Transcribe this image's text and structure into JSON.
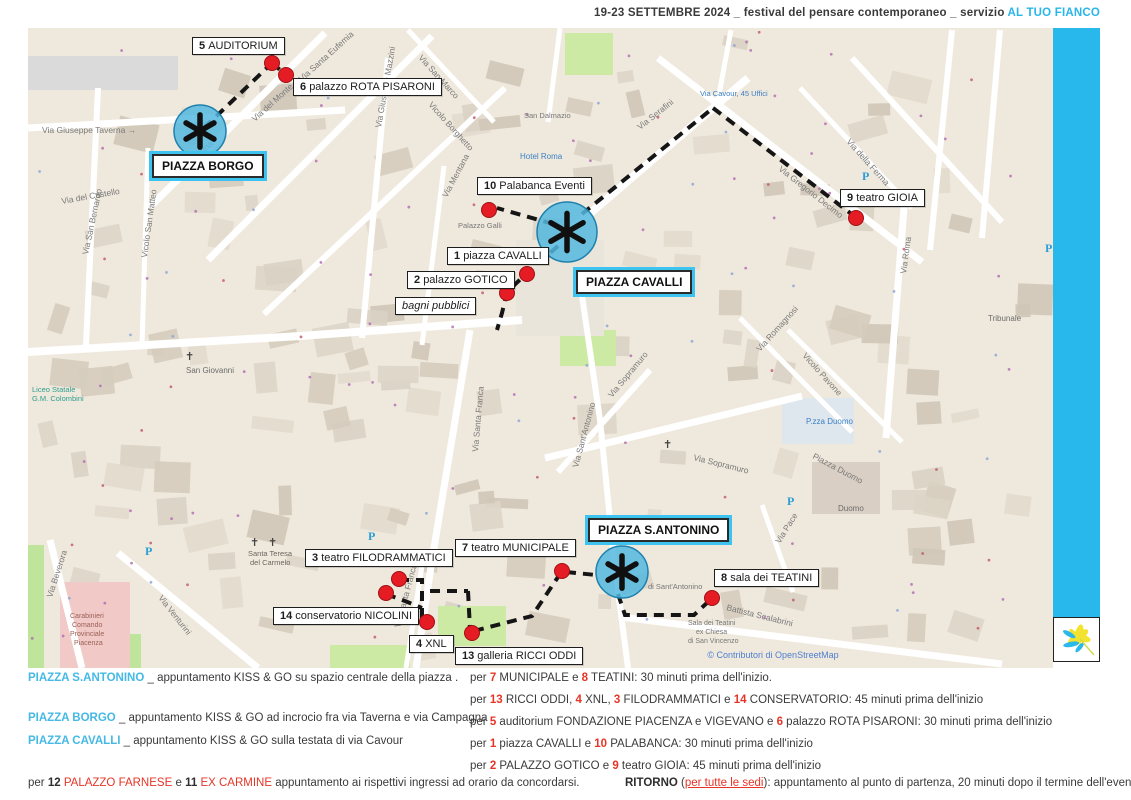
{
  "header": {
    "title_plain": "19-23 SETTEMBRE 2024 _ festival del pensare contemporaneo _ servizio ",
    "title_accent": "AL TUO FIANCO"
  },
  "colors": {
    "accent": "#29b8eb",
    "red_dot": "#e51c23",
    "route": "#151515",
    "kissgo_fill": "#55b8df",
    "kissgo_stroke": "#1f81ad"
  },
  "map": {
    "attribution": "© Contributori di OpenStreetMap",
    "kiss_go_points": [
      {
        "name": "piazza-borgo",
        "x": 200,
        "y": 131,
        "r": 26
      },
      {
        "name": "piazza-cavalli",
        "x": 567,
        "y": 232,
        "r": 30
      },
      {
        "name": "piazza-santantonino",
        "x": 622,
        "y": 572,
        "r": 26
      }
    ],
    "piazza_labels": [
      {
        "text": "PIAZZA BORGO",
        "x": 152,
        "y": 154
      },
      {
        "text": "PIAZZA CAVALLI",
        "x": 576,
        "y": 270
      },
      {
        "text": "PIAZZA S.ANTONINO",
        "x": 588,
        "y": 518
      }
    ],
    "venues": [
      {
        "num": "5",
        "name": "AUDITORIUM",
        "x": 192,
        "y": 37,
        "dot": {
          "x": 272,
          "y": 63
        }
      },
      {
        "num": "6",
        "name": "palazzo ROTA PISARONI",
        "x": 293,
        "y": 78,
        "dot": {
          "x": 286,
          "y": 75
        }
      },
      {
        "num": "10",
        "name": "Palabanca Eventi",
        "x": 477,
        "y": 177,
        "dot": {
          "x": 489,
          "y": 210
        }
      },
      {
        "num": "1",
        "name": "piazza CAVALLI",
        "x": 447,
        "y": 247,
        "dot": {
          "x": 527,
          "y": 274
        }
      },
      {
        "num": "2",
        "name": "palazzo GOTICO",
        "x": 407,
        "y": 271,
        "dot": {
          "x": 507,
          "y": 293
        }
      },
      {
        "num": "",
        "name": "bagni pubblici",
        "italic": true,
        "x": 395,
        "y": 297,
        "dot": null
      },
      {
        "num": "9",
        "name": "teatro GIOIA",
        "x": 840,
        "y": 189,
        "dot": {
          "x": 856,
          "y": 218
        }
      },
      {
        "num": "7",
        "name": "teatro MUNICIPALE",
        "x": 455,
        "y": 539,
        "dot": {
          "x": 562,
          "y": 571
        }
      },
      {
        "num": "3",
        "name": "teatro FILODRAMMATICI",
        "x": 305,
        "y": 549,
        "dot": {
          "x": 399,
          "y": 579
        }
      },
      {
        "num": "14",
        "name": "conservatorio NICOLINI",
        "x": 273,
        "y": 607,
        "dot": {
          "x": 386,
          "y": 593
        }
      },
      {
        "num": "4",
        "name": "XNL",
        "x": 409,
        "y": 635,
        "dot": {
          "x": 427,
          "y": 622
        }
      },
      {
        "num": "13",
        "name": "galleria RICCI ODDI",
        "x": 455,
        "y": 647,
        "dot": {
          "x": 472,
          "y": 633
        }
      },
      {
        "num": "8",
        "name": "sala dei TEATINI",
        "x": 714,
        "y": 569,
        "dot": {
          "x": 712,
          "y": 598
        }
      }
    ],
    "routes": [
      "204,128 272,63",
      "272,63 286,75",
      "582,214 713,108",
      "713,108 854,216",
      "553,224 497,208",
      "558,246 527,273 507,292 502,313 497,330",
      "399,580 422,580 422,621",
      "386,594 405,601 422,608",
      "430,591 468,591",
      "468,591 470,629",
      "474,631 532,616 560,574",
      "566,572 596,575",
      "618,594 625,615 694,615 709,601"
    ],
    "street_labels": [
      {
        "t": "Via Giuseppe Taverna →",
        "x": 42,
        "y": 133,
        "r": 0
      },
      {
        "t": "Via San Bernardo",
        "x": 88,
        "y": 255,
        "r": -78
      },
      {
        "t": "Via del Castello",
        "x": 62,
        "y": 204,
        "r": -10
      },
      {
        "t": "Vicolo San Matteo",
        "x": 147,
        "y": 258,
        "r": -82
      },
      {
        "t": "Via Campagna",
        "x": 172,
        "y": 182,
        "r": -42
      },
      {
        "t": "Via del Monte",
        "x": 255,
        "y": 122,
        "r": -42
      },
      {
        "t": "Via Santa Eufemia",
        "x": 302,
        "y": 82,
        "r": -42
      },
      {
        "t": "Via San Marco",
        "x": 418,
        "y": 58,
        "r": 48
      },
      {
        "t": "Vicolo Borghetto",
        "x": 428,
        "y": 105,
        "r": 48
      },
      {
        "t": "Via Giuseppe Mazzini",
        "x": 381,
        "y": 128,
        "r": -80
      },
      {
        "t": "Via Mentana",
        "x": 447,
        "y": 198,
        "r": -62
      },
      {
        "t": "Via Serafini",
        "x": 640,
        "y": 130,
        "r": -38
      },
      {
        "t": "Via Gregorio Decimo",
        "x": 778,
        "y": 170,
        "r": 38
      },
      {
        "t": "Via della Ferma",
        "x": 846,
        "y": 142,
        "r": 48
      },
      {
        "t": "Via Romagnosi",
        "x": 760,
        "y": 352,
        "r": -48
      },
      {
        "t": "Vicolo Pavone",
        "x": 802,
        "y": 356,
        "r": 48
      },
      {
        "t": "Via Sopramuro",
        "x": 612,
        "y": 398,
        "r": -50
      },
      {
        "t": "Via Sopramuro",
        "x": 693,
        "y": 460,
        "r": 14
      },
      {
        "t": "Via Santa Franca",
        "x": 478,
        "y": 452,
        "r": -85
      },
      {
        "t": "Via Santa Franca",
        "x": 400,
        "y": 628,
        "r": -75
      },
      {
        "t": "Via Sant'Antonino",
        "x": 578,
        "y": 468,
        "r": -75
      },
      {
        "t": "Via Roma",
        "x": 906,
        "y": 274,
        "r": -82
      },
      {
        "t": "Via Venturini",
        "x": 158,
        "y": 598,
        "r": 52
      },
      {
        "t": "Via Beverora",
        "x": 52,
        "y": 598,
        "r": -72
      },
      {
        "t": "Battista Scalabrini",
        "x": 726,
        "y": 610,
        "r": 14
      },
      {
        "t": "Via Pace",
        "x": 780,
        "y": 544,
        "r": -58
      },
      {
        "t": "Piazza Duomo",
        "x": 812,
        "y": 458,
        "r": 28
      }
    ],
    "place_labels": [
      {
        "t": "San Giovanni",
        "x": 186,
        "y": 373,
        "c": "#6b6b6b",
        "s": 8
      },
      {
        "t": "Santa Teresa",
        "x": 248,
        "y": 556,
        "c": "#6d655f",
        "s": 7.5
      },
      {
        "t": "del Carmelo",
        "x": 250,
        "y": 565,
        "c": "#6d655f",
        "s": 7.5
      },
      {
        "t": "Hotel Roma",
        "x": 520,
        "y": 159,
        "c": "#3b7fc4",
        "s": 8
      },
      {
        "t": "San Dalmazio",
        "x": 524,
        "y": 118,
        "c": "#777777",
        "s": 7.5
      },
      {
        "t": "Via Cavour, 45 Uffici",
        "x": 700,
        "y": 96,
        "c": "#3b7fc4",
        "s": 7.5
      },
      {
        "t": "Palazzo Galli",
        "x": 458,
        "y": 228,
        "c": "#777777",
        "s": 7.5
      },
      {
        "t": "P.zza Duomo",
        "x": 806,
        "y": 424,
        "c": "#3b7fc4",
        "s": 8
      },
      {
        "t": "Duomo",
        "x": 838,
        "y": 511,
        "c": "#6b6b6b",
        "s": 8
      },
      {
        "t": "Tribunale",
        "x": 988,
        "y": 321,
        "c": "#6b6b6b",
        "s": 8
      },
      {
        "t": "Sala dei Teatini",
        "x": 688,
        "y": 625,
        "c": "#777777",
        "s": 7
      },
      {
        "t": "ex Chiesa",
        "x": 696,
        "y": 634,
        "c": "#777777",
        "s": 7
      },
      {
        "t": "di San Vincenzo",
        "x": 688,
        "y": 643,
        "c": "#777777",
        "s": 7
      },
      {
        "t": "di Sant'Antonino",
        "x": 648,
        "y": 589,
        "c": "#777777",
        "s": 7.5
      },
      {
        "t": "Liceo Statale",
        "x": 32,
        "y": 392,
        "c": "#2f9e8f",
        "s": 7.5
      },
      {
        "t": "G.M. Colombini",
        "x": 32,
        "y": 401,
        "c": "#2f9e8f",
        "s": 7.5
      },
      {
        "t": "Carabinieri",
        "x": 70,
        "y": 618,
        "c": "#9a6258",
        "s": 7
      },
      {
        "t": "Comando",
        "x": 72,
        "y": 627,
        "c": "#9a6258",
        "s": 7
      },
      {
        "t": "Provinciale",
        "x": 70,
        "y": 636,
        "c": "#9a6258",
        "s": 7
      },
      {
        "t": "Piacenza",
        "x": 74,
        "y": 645,
        "c": "#9a6258",
        "s": 7
      }
    ],
    "parking_letter": "P",
    "parking": [
      {
        "x": 368,
        "y": 540
      },
      {
        "x": 787,
        "y": 505
      },
      {
        "x": 862,
        "y": 180
      },
      {
        "x": 145,
        "y": 555
      },
      {
        "x": 1045,
        "y": 252
      }
    ],
    "cross_glyph": "✝",
    "crosses": [
      {
        "x": 255,
        "y": 172
      },
      {
        "x": 185,
        "y": 360
      },
      {
        "x": 663,
        "y": 448
      },
      {
        "x": 250,
        "y": 546
      },
      {
        "x": 268,
        "y": 546
      }
    ]
  },
  "legend": {
    "left": [
      {
        "x": 28,
        "y": 672,
        "segments": [
          {
            "t": "PIAZZA S.ANTONINO",
            "s": "cyan"
          },
          {
            "t": " _ appuntamento KISS & GO su spazio centrale della piazza .",
            "s": ""
          }
        ]
      },
      {
        "x": 28,
        "y": 712,
        "segments": [
          {
            "t": "PIAZZA BORGO",
            "s": "cyan"
          },
          {
            "t": " _ appuntamento KISS & GO ad incrocio fra via Taverna e via Campagna",
            "s": ""
          }
        ]
      },
      {
        "x": 28,
        "y": 735,
        "segments": [
          {
            "t": "PIAZZA CAVALLI",
            "s": "cyan"
          },
          {
            "t": " _ appuntamento KISS & GO sulla testata di via Cavour",
            "s": ""
          }
        ]
      },
      {
        "x": 28,
        "y": 777,
        "segments": [
          {
            "t": "per ",
            "s": ""
          },
          {
            "t": "12",
            "s": "b"
          },
          {
            "t": " ",
            "s": ""
          },
          {
            "t": "PALAZZO FARNESE",
            "s": "r"
          },
          {
            "t": " e ",
            "s": ""
          },
          {
            "t": "11",
            "s": "b"
          },
          {
            "t": " ",
            "s": ""
          },
          {
            "t": "EX CARMINE",
            "s": "r"
          },
          {
            "t": " appuntamento ai rispettivi ingressi ad orario da concordarsi.",
            "s": ""
          }
        ]
      }
    ],
    "right": [
      {
        "x": 470,
        "y": 672,
        "segments": [
          {
            "t": "per ",
            "s": ""
          },
          {
            "t": "7",
            "s": "rb"
          },
          {
            "t": " MUNICIPALE e ",
            "s": ""
          },
          {
            "t": "8",
            "s": "rb"
          },
          {
            "t": " TEATINI: 30 minuti prima dell'inizio.",
            "s": ""
          }
        ]
      },
      {
        "x": 470,
        "y": 694,
        "segments": [
          {
            "t": "per ",
            "s": ""
          },
          {
            "t": "13",
            "s": "rb"
          },
          {
            "t": " RICCI ODDI, ",
            "s": ""
          },
          {
            "t": "4",
            "s": "rb"
          },
          {
            "t": " XNL, ",
            "s": ""
          },
          {
            "t": "3",
            "s": "rb"
          },
          {
            "t": " FILODRAMMATICI e ",
            "s": ""
          },
          {
            "t": "14",
            "s": "rb"
          },
          {
            "t": " CONSERVATORIO: 45 minuti prima dell'inizio",
            "s": ""
          }
        ]
      },
      {
        "x": 470,
        "y": 716,
        "segments": [
          {
            "t": "per ",
            "s": ""
          },
          {
            "t": "5",
            "s": "rb"
          },
          {
            "t": " auditorium FONDAZIONE PIACENZA e VIGEVANO e ",
            "s": ""
          },
          {
            "t": "6",
            "s": "rb"
          },
          {
            "t": " palazzo ROTA PISARONI: 30 minuti prima dell'inizio",
            "s": ""
          }
        ]
      },
      {
        "x": 470,
        "y": 738,
        "segments": [
          {
            "t": "per ",
            "s": ""
          },
          {
            "t": "1",
            "s": "rb"
          },
          {
            "t": " piazza CAVALLI e ",
            "s": ""
          },
          {
            "t": "10",
            "s": "rb"
          },
          {
            "t": " PALABANCA: 30 minuti prima dell'inizio",
            "s": ""
          }
        ]
      },
      {
        "x": 470,
        "y": 760,
        "segments": [
          {
            "t": "per ",
            "s": ""
          },
          {
            "t": "2",
            "s": "rb"
          },
          {
            "t": " PALAZZO GOTICO e ",
            "s": ""
          },
          {
            "t": "9",
            "s": "rb"
          },
          {
            "t": " teatro GIOIA: 45 minuti prima dell'inizio",
            "s": ""
          }
        ]
      },
      {
        "x": 625,
        "y": 777,
        "segments": [
          {
            "t": "RITORNO",
            "s": "b"
          },
          {
            "t": " (",
            "s": ""
          },
          {
            "t": "per tutte le sedi",
            "s": "ru"
          },
          {
            "t": "): appuntamento al punto di partenza, 20 minuti dopo il termine dell'evento",
            "s": ""
          }
        ]
      }
    ]
  }
}
